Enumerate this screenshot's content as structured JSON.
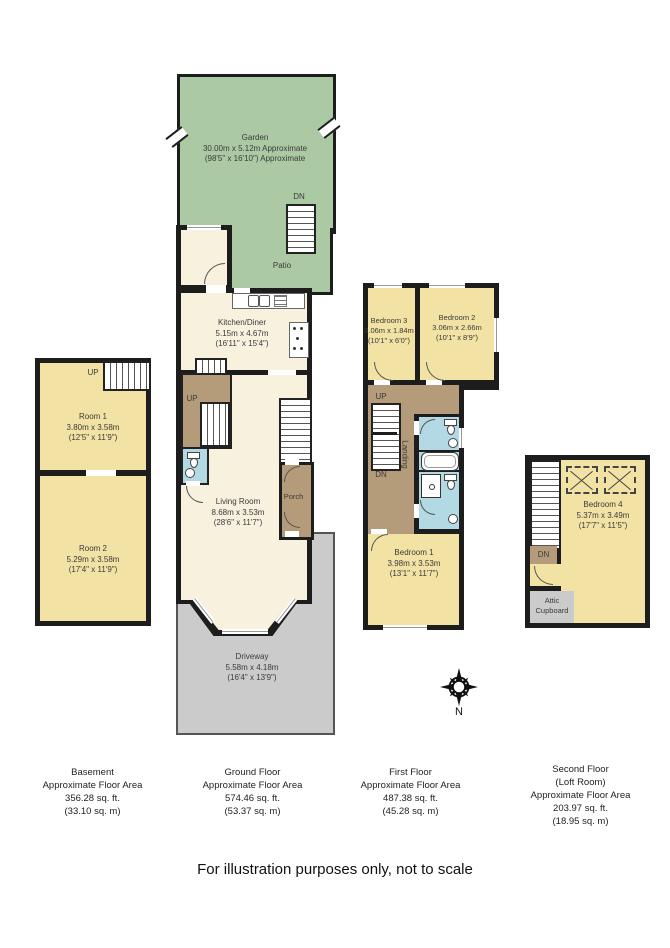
{
  "disclaimer": "For illustration purposes only, not to scale",
  "compass": {
    "north_label": "N"
  },
  "colors": {
    "wall": "#1d1d1d",
    "room_cream": "#f7f1dd",
    "room_yellow": "#f2e2a4",
    "garden_green": "#abc9a3",
    "stairs_brown": "#b49b79",
    "bathroom_blue": "#b3d9e5",
    "driveway_grey": "#cbcbcb"
  },
  "plans": {
    "basement": {
      "area_lines": [
        "Basement",
        "Approximate Floor Area",
        "356.28 sq. ft.",
        "(33.10 sq. m)"
      ],
      "up_label": "UP",
      "room1": {
        "name": "Room 1",
        "dims_m": "3.80m x 3.58m",
        "dims_ft": "(12'5\" x 11'9\")"
      },
      "room2": {
        "name": "Room 2",
        "dims_m": "5.29m x 3.58m",
        "dims_ft": "(17'4\" x 11'9\")"
      }
    },
    "ground": {
      "area_lines": [
        "Ground Floor",
        "Approximate Floor Area",
        "574.46 sq. ft.",
        "(53.37 sq. m)"
      ],
      "garden": {
        "name": "Garden",
        "dims_m": "30.00m x 5.12m Approximate",
        "dims_ft": "(98'5\" x 16'10\") Approximate"
      },
      "patio": {
        "name": "Patio"
      },
      "dn_label": "DN",
      "up_label": "UP",
      "kitchen": {
        "name": "Kitchen/Diner",
        "dims_m": "5.15m x 4.67m",
        "dims_ft": "(16'11\" x 15'4\")"
      },
      "living": {
        "name": "Living Room",
        "dims_m": "8.68m x 3.53m",
        "dims_ft": "(28'6\" x 11'7\")"
      },
      "porch": {
        "name": "Porch"
      },
      "driveway": {
        "name": "Driveway",
        "dims_m": "5.58m x 4.18m",
        "dims_ft": "(16'4\" x 13'9\")"
      }
    },
    "first": {
      "area_lines": [
        "First Floor",
        "Approximate Floor Area",
        "487.38 sq. ft.",
        "(45.28 sq. m)"
      ],
      "up_label": "UP",
      "dn_label": "DN",
      "landing_label": "Landing",
      "bedroom3": {
        "name": "Bedroom 3",
        "dims_m": "3.06m x 1.84m",
        "dims_ft": "(10'1\" x 6'0\")"
      },
      "bedroom2": {
        "name": "Bedroom 2",
        "dims_m": "3.06m x 2.66m",
        "dims_ft": "(10'1\" x 8'9\")"
      },
      "bedroom1": {
        "name": "Bedroom 1",
        "dims_m": "3.98m x 3.53m",
        "dims_ft": "(13'1\" x 11'7\")"
      }
    },
    "second": {
      "area_lines": [
        "Second Floor",
        "(Loft Room)",
        "Approximate Floor Area",
        "203.97 sq. ft.",
        "(18.95 sq. m)"
      ],
      "dn_label": "DN",
      "bedroom4": {
        "name": "Bedroom 4",
        "dims_m": "5.37m x 3.49m",
        "dims_ft": "(17'7\" x 11'5\")"
      },
      "attic_lines": [
        "Attic",
        "Cupboard"
      ]
    }
  }
}
